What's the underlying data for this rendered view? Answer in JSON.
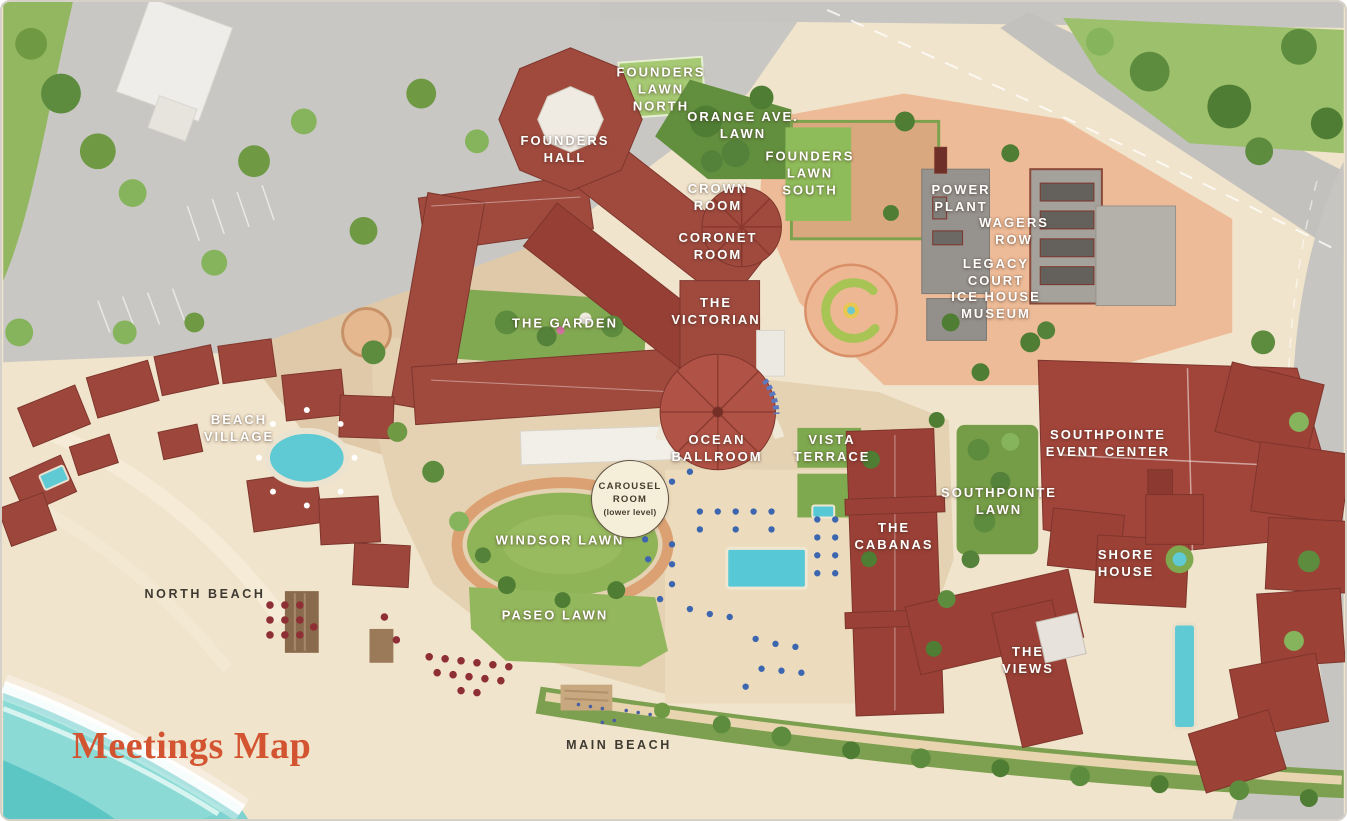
{
  "map": {
    "title": "Meetings Map",
    "property": "resort-meetings-map"
  },
  "labels": {
    "founders_lawn_north": "FOUNDERS\nLAWN\nNORTH",
    "orange_ave_lawn": "ORANGE AVE.\nLAWN",
    "founders_hall": "FOUNDERS\nHALL",
    "founders_lawn_south": "FOUNDERS\nLAWN\nSOUTH",
    "crown_room": "CROWN\nROOM",
    "coronet_room": "CORONET\nROOM",
    "the_victorian": "THE\nVICTORIAN",
    "the_garden": "THE GARDEN",
    "power_plant": "POWER\nPLANT",
    "wagers_row": "WAGERS\nROW",
    "legacy_court": "LEGACY\nCOURT",
    "ice_house_museum": "ICE HOUSE\nMUSEUM",
    "ocean_ballroom": "OCEAN\nBALLROOM",
    "vista_terrace": "VISTA\nTERRACE",
    "beach_village": "BEACH\nVILLAGE",
    "southpointe_event_center": "SOUTHPOINTE\nEVENT CENTER",
    "southpointe_lawn": "SOUTHPOINTE\nLAWN",
    "windsor_lawn": "WINDSOR LAWN",
    "paseo_lawn": "PASEO LAWN",
    "the_cabanas": "THE\nCABANAS",
    "shore_house": "SHORE\nHOUSE",
    "the_views": "THE\nVIEWS",
    "north_beach": "NORTH BEACH",
    "main_beach": "MAIN BEACH"
  },
  "carousel": {
    "room": "CAROUSEL\nROOM",
    "level": "(lower level)"
  },
  "colors": {
    "title_orange": "#d35431",
    "label_white": "#ffffff",
    "label_dark": "#3e3a31",
    "ocean": "#7ed2cf",
    "sand": "#f1e4cc",
    "grass": "#8fb457",
    "grass_dark": "#5d8c3e",
    "roof_red": "#a04a3e",
    "paving_salmon": "#edbb97",
    "paving_tan": "#e4d2b3",
    "road_gray": "#c8c7c3",
    "building_gray": "#96938e",
    "building_white": "#efede9",
    "pool_blue": "#57c8d6",
    "umbrella_blue": "#3d66b0",
    "umbrella_red": "#8e2f35",
    "carousel_bg": "#f5eed9"
  }
}
